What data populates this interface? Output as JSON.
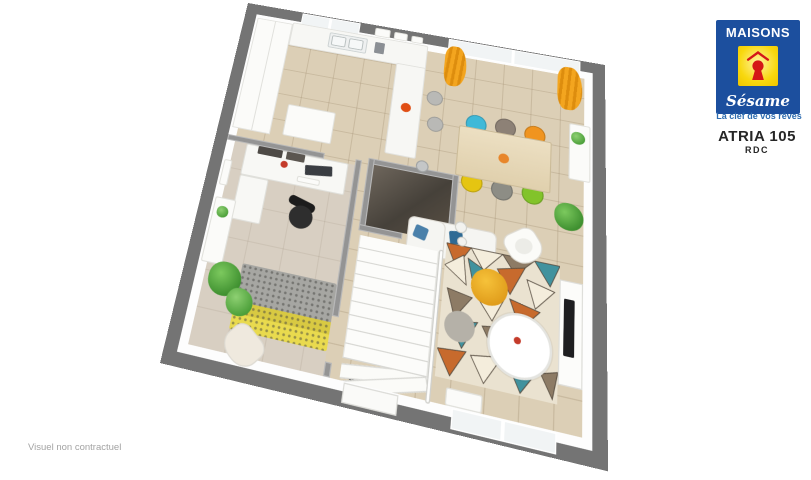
{
  "branding": {
    "logo_line1": "MAISONS",
    "logo_line2": "Sésame",
    "tagline": "La clef de vos rêves"
  },
  "plan": {
    "model_name": "ATRIA 105",
    "floor_label": "RDC",
    "disclaimer": "Visuel non contractuel"
  },
  "colors": {
    "logo-blue": "#1c4f9e",
    "logo-yellow": "#f8d80e",
    "logo-red": "#d41717",
    "tagline-blue": "#2e6cb0",
    "title-dark": "#262626",
    "disclaimer-gray": "#a3a3a3",
    "wall-gray": "#747474",
    "inner-wall": "#949494",
    "floor-beige": "#dccfb6",
    "floor-office": "#d8cfc2",
    "curtain-orange": "#efa11c"
  },
  "dining": {
    "chair_styles": [
      "background:#3fb9d8",
      "background:#8d8176",
      "background:#f0941f",
      "background:#e5c511",
      "background:#8d8d85",
      "background:#82c32a"
    ]
  }
}
